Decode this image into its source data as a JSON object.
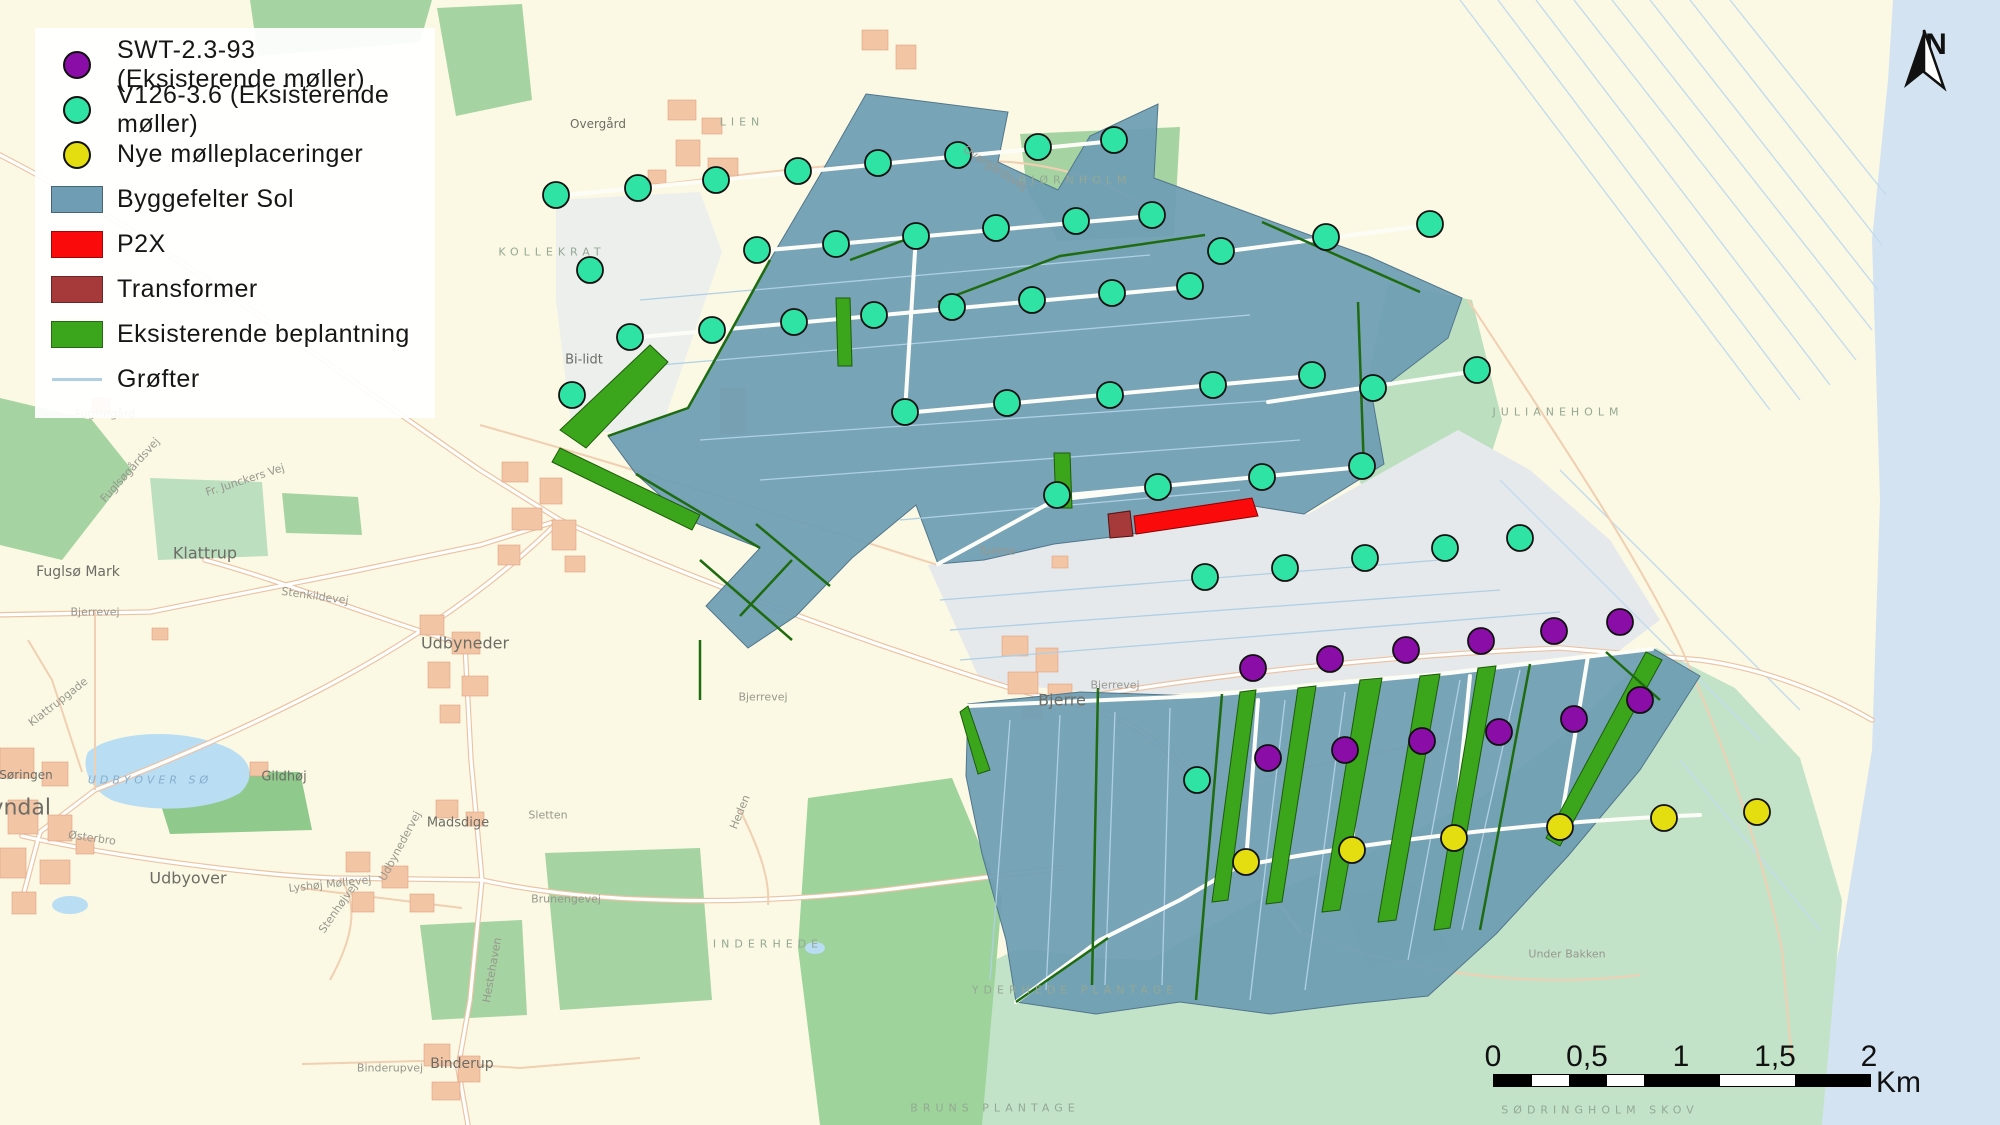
{
  "legend": {
    "items": [
      {
        "id": "swt",
        "symbol": "circle",
        "color": "#8A0DA8",
        "label": "SWT-2.3-93 (Eksisterende møller)"
      },
      {
        "id": "v126",
        "symbol": "circle",
        "color": "#2FE3A4",
        "label": "V126-3.6 (Eksisterende møller)"
      },
      {
        "id": "nye",
        "symbol": "circle",
        "color": "#E4DE10",
        "label": "Nye mølleplaceringer"
      },
      {
        "id": "sol",
        "symbol": "rect",
        "color": "#6E9DB4",
        "label": "Byggefelter Sol"
      },
      {
        "id": "p2x",
        "symbol": "rect",
        "color": "#FA0A0A",
        "label": "P2X"
      },
      {
        "id": "transformer",
        "symbol": "rect",
        "color": "#A63A3A",
        "label": "Transformer"
      },
      {
        "id": "beplantning",
        "symbol": "rect",
        "color": "#3BA51B",
        "label": "Eksisterende beplantning"
      },
      {
        "id": "grofter",
        "symbol": "line",
        "color": "#AFCFE4",
        "label": "Grøfter"
      }
    ]
  },
  "north_arrow": {
    "label": "N"
  },
  "scale_bar": {
    "tick_labels": [
      "0",
      "0,5",
      "1",
      "1,5",
      "2"
    ],
    "unit": "Km"
  },
  "map": {
    "colors": {
      "swt": "#8A0DA8",
      "v126": "#2FE3A4",
      "nye": "#E4DE10",
      "sol": "#6E9DB4",
      "p2x": "#FA0A0A",
      "transformer": "#A63A3A",
      "beplantning": "#3BA51B",
      "grofter": "#AFCFE4"
    },
    "turbines": {
      "swt": [
        [
          1253,
          668
        ],
        [
          1330,
          659
        ],
        [
          1406,
          650
        ],
        [
          1481,
          641
        ],
        [
          1554,
          631
        ],
        [
          1620,
          622
        ],
        [
          1268,
          758
        ],
        [
          1345,
          750
        ],
        [
          1422,
          741
        ],
        [
          1499,
          732
        ],
        [
          1574,
          719
        ],
        [
          1640,
          700
        ]
      ],
      "v126": [
        [
          556,
          195
        ],
        [
          638,
          188
        ],
        [
          716,
          180
        ],
        [
          798,
          171
        ],
        [
          878,
          163
        ],
        [
          958,
          155
        ],
        [
          1038,
          147
        ],
        [
          1114,
          140
        ],
        [
          590,
          270
        ],
        [
          757,
          250
        ],
        [
          836,
          244
        ],
        [
          916,
          236
        ],
        [
          996,
          228
        ],
        [
          1076,
          221
        ],
        [
          1152,
          215
        ],
        [
          1221,
          251
        ],
        [
          1326,
          237
        ],
        [
          1430,
          224
        ],
        [
          572,
          395
        ],
        [
          630,
          337
        ],
        [
          712,
          330
        ],
        [
          794,
          322
        ],
        [
          874,
          315
        ],
        [
          952,
          307
        ],
        [
          1032,
          300
        ],
        [
          1112,
          293
        ],
        [
          1190,
          286
        ],
        [
          905,
          412
        ],
        [
          1007,
          403
        ],
        [
          1110,
          395
        ],
        [
          1213,
          385
        ],
        [
          1312,
          375
        ],
        [
          1373,
          388
        ],
        [
          1477,
          370
        ],
        [
          1057,
          495
        ],
        [
          1158,
          487
        ],
        [
          1262,
          477
        ],
        [
          1362,
          466
        ],
        [
          1205,
          577
        ],
        [
          1285,
          568
        ],
        [
          1365,
          558
        ],
        [
          1445,
          548
        ],
        [
          1520,
          538
        ],
        [
          1197,
          780
        ]
      ],
      "nye": [
        [
          1246,
          862
        ],
        [
          1352,
          850
        ],
        [
          1454,
          838
        ],
        [
          1560,
          827
        ],
        [
          1664,
          818
        ],
        [
          1757,
          812
        ]
      ]
    },
    "labels": [
      {
        "t": "Overgård",
        "x": 598,
        "y": 124,
        "c": "village",
        "fs": 12
      },
      {
        "t": "LIEN",
        "x": 742,
        "y": 122,
        "c": "area"
      },
      {
        "t": "BJØRNHOLM",
        "x": 1075,
        "y": 180,
        "c": "area"
      },
      {
        "t": "Overgårdsvej",
        "x": 995,
        "y": 168,
        "c": "road",
        "r": 33
      },
      {
        "t": "KOLLEKRAT",
        "x": 552,
        "y": 252,
        "c": "area"
      },
      {
        "t": "Bi-lidt",
        "x": 584,
        "y": 360,
        "c": "village",
        "fs": 13
      },
      {
        "t": "JULIANEHOLM",
        "x": 1558,
        "y": 412,
        "c": "area"
      },
      {
        "t": "Fuglsøgård",
        "x": 105,
        "y": 414,
        "c": "road"
      },
      {
        "t": "Fuglsøgårdsvej",
        "x": 130,
        "y": 470,
        "c": "road",
        "r": -48
      },
      {
        "t": "Fr. Junckers Vej",
        "x": 245,
        "y": 480,
        "c": "road",
        "r": -18
      },
      {
        "t": "Klattrup",
        "x": 205,
        "y": 553,
        "c": "village",
        "fs": 16
      },
      {
        "t": "Fuglsø Mark",
        "x": 78,
        "y": 572,
        "c": "village",
        "fs": 14
      },
      {
        "t": "Stenkildevej",
        "x": 315,
        "y": 596,
        "c": "road",
        "r": 8
      },
      {
        "t": "Bjerrevej",
        "x": 95,
        "y": 612,
        "c": "road"
      },
      {
        "t": "Udbyneder",
        "x": 465,
        "y": 643,
        "c": "village",
        "fs": 16
      },
      {
        "t": "Bjerrevej",
        "x": 763,
        "y": 697,
        "c": "road"
      },
      {
        "t": "Bjerre",
        "x": 1062,
        "y": 700,
        "c": "village",
        "fs": 16
      },
      {
        "t": "Bjerrevej",
        "x": 1115,
        "y": 685,
        "c": "road"
      },
      {
        "t": "Tuerne",
        "x": 997,
        "y": 551,
        "c": "road"
      },
      {
        "t": "Gildhøj",
        "x": 284,
        "y": 777,
        "c": "village",
        "fs": 13
      },
      {
        "t": "Søringen",
        "x": 26,
        "y": 775,
        "c": "village",
        "fs": 12
      },
      {
        "t": "avndal",
        "x": 14,
        "y": 808,
        "c": "village",
        "fs": 22
      },
      {
        "t": "UDBYOVER SØ",
        "x": 150,
        "y": 780,
        "c": "water-label"
      },
      {
        "t": "Østerbro",
        "x": 92,
        "y": 838,
        "c": "road",
        "r": 8
      },
      {
        "t": "Udbyover",
        "x": 188,
        "y": 878,
        "c": "village",
        "fs": 16
      },
      {
        "t": "Madsdige",
        "x": 458,
        "y": 823,
        "c": "village",
        "fs": 13
      },
      {
        "t": "Sletten",
        "x": 548,
        "y": 815,
        "c": "road"
      },
      {
        "t": "Lyshøj Møllevej",
        "x": 330,
        "y": 884,
        "c": "road",
        "r": -6
      },
      {
        "t": "Udbynedervej",
        "x": 400,
        "y": 846,
        "c": "road",
        "r": -62
      },
      {
        "t": "Stenhøjvej",
        "x": 338,
        "y": 908,
        "c": "road",
        "r": -55
      },
      {
        "t": "Klattrupgade",
        "x": 58,
        "y": 702,
        "c": "road",
        "r": -38
      },
      {
        "t": "Brunengevej",
        "x": 566,
        "y": 899,
        "c": "road"
      },
      {
        "t": "Hestehaven",
        "x": 492,
        "y": 970,
        "c": "road",
        "r": -80
      },
      {
        "t": "Heden",
        "x": 740,
        "y": 812,
        "c": "road",
        "r": -68
      },
      {
        "t": "INDERHEDE",
        "x": 768,
        "y": 944,
        "c": "area"
      },
      {
        "t": "YDERHEDE PLANTAGE",
        "x": 1075,
        "y": 990,
        "c": "area"
      },
      {
        "t": "BRUNS PLANTAGE",
        "x": 995,
        "y": 1108,
        "c": "area"
      },
      {
        "t": "Binderupvej",
        "x": 390,
        "y": 1068,
        "c": "road"
      },
      {
        "t": "Binderup",
        "x": 462,
        "y": 1064,
        "c": "village",
        "fs": 14
      },
      {
        "t": "Under Bakken",
        "x": 1567,
        "y": 954,
        "c": "road"
      },
      {
        "t": "SØDRINGHOLM SKOV",
        "x": 1600,
        "y": 1110,
        "c": "area"
      }
    ]
  }
}
